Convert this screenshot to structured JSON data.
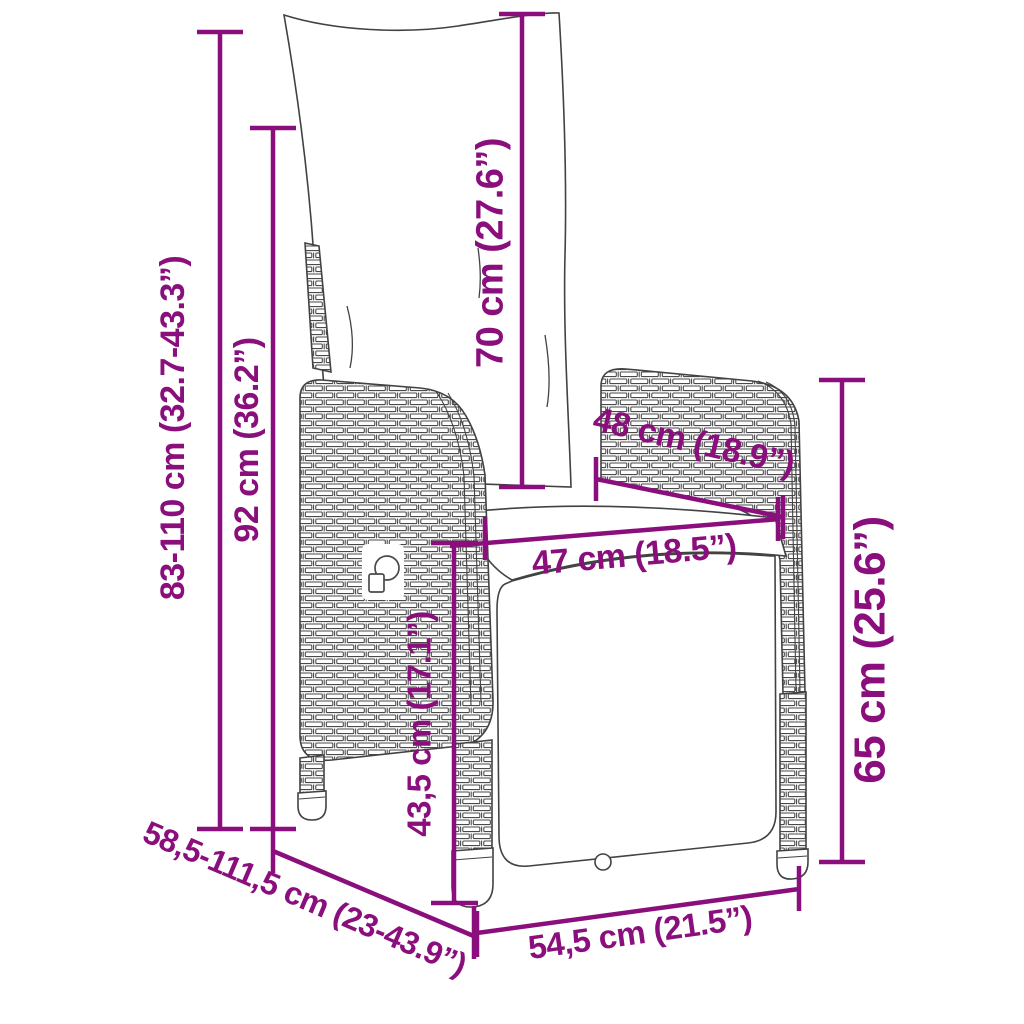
{
  "diagram": {
    "title": "Reclining garden chair with cushions – dimension drawing",
    "colors": {
      "dimension": "#8a0f7d",
      "line_art": "#424242"
    },
    "dimensions": [
      {
        "id": "overall-height-range",
        "label": "83-110 cm (32.7-43.3”)"
      },
      {
        "id": "backrest-height",
        "label": "92 cm (36.2”)"
      },
      {
        "id": "back-cushion-height",
        "label": "70 cm (27.6”)"
      },
      {
        "id": "seat-depth",
        "label": "48 cm (18.9”)"
      },
      {
        "id": "seat-width",
        "label": "47 cm (18.5”)"
      },
      {
        "id": "armrest-height",
        "label": "65 cm (25.6”)"
      },
      {
        "id": "seat-height",
        "label": "43,5 cm (17.1”)"
      },
      {
        "id": "extended-depth-range",
        "label": "58,5-111,5 cm (23-43.9”)"
      },
      {
        "id": "base-width",
        "label": "54,5 cm (21.5”)"
      }
    ]
  }
}
